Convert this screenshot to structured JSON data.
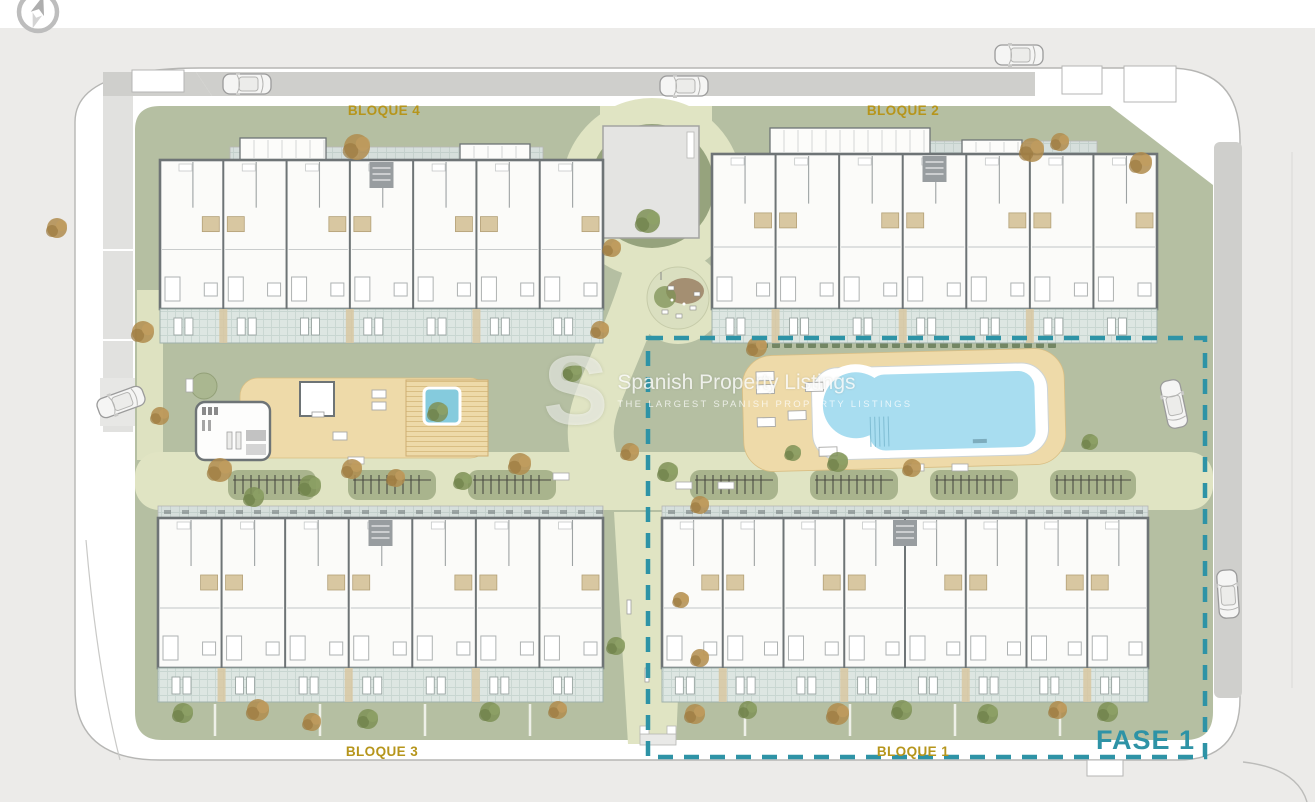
{
  "plan": {
    "block_labels": [
      {
        "id": "bloque4",
        "text": "BLOQUE 4"
      },
      {
        "id": "bloque2",
        "text": "BLOQUE 2"
      },
      {
        "id": "bloque3",
        "text": "BLOQUE 3"
      },
      {
        "id": "bloque1",
        "text": "BLOQUE 1"
      }
    ],
    "phase_label": "FASE 1"
  },
  "watermark": {
    "logo_letter": "S",
    "title": "Spanish Property Listings",
    "subtitle": "THE LARGEST SPANISH PROPERTY LISTINGS"
  },
  "icons": {
    "compass": "compass-rose"
  },
  "colors": {
    "canvas": "#ecebe9",
    "site": "#ffffff",
    "outline": "#b6b6b4",
    "road": "#cfcfcc",
    "road_light": "#e1e1df",
    "lawn": "#b5bfa2",
    "lawn_dark": "#96a37d",
    "path_pale": "#e0e4c3",
    "mound": "#a9b48d",
    "deck_tan": "#eedaa9",
    "deck_line": "#d9be83",
    "pool_water": "#a8ddf0",
    "spa_water": "#85cbdd",
    "terrace": "#dde6e2",
    "terrace_line": "#c8d6d1",
    "plaza": "#d6dfdc",
    "plaza_line": "#c3d0cc",
    "wall": "#6e7476",
    "building": "#fbfbf9",
    "bath": "#d8c7a1",
    "gold": "#b6951b",
    "teal": "#2e93a6",
    "tree_green": "#7e9156",
    "tree_brown": "#ad8a4d",
    "hedge": "#6c7f5c",
    "car": "#f5f5f4"
  }
}
